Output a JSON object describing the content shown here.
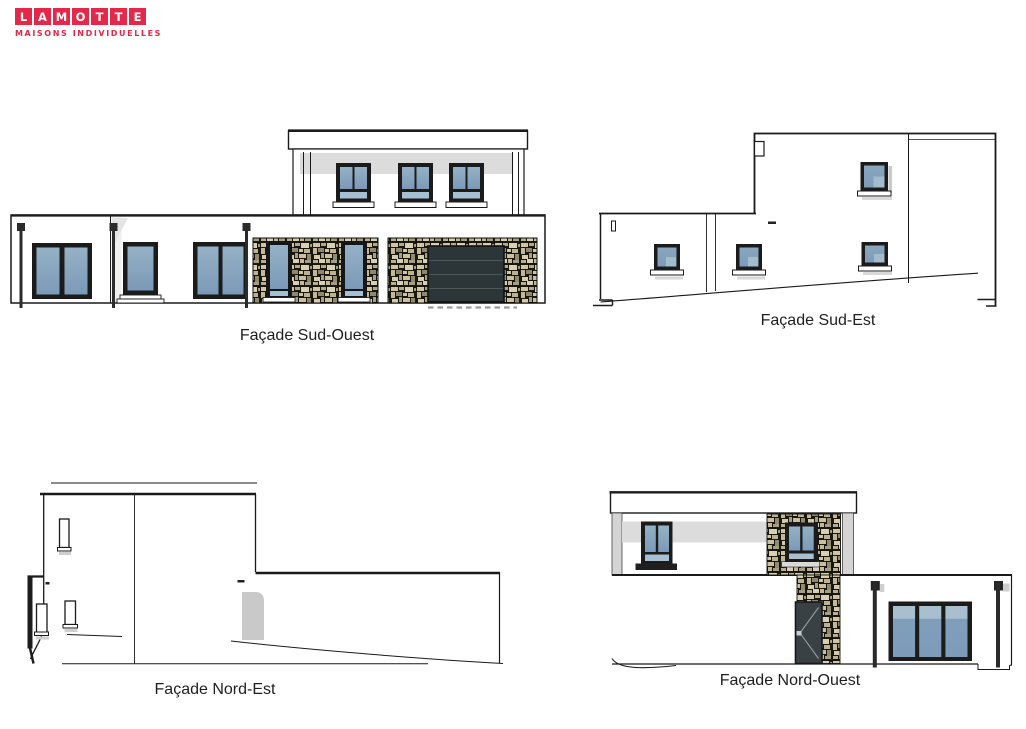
{
  "logo": {
    "letters": [
      "L",
      "A",
      "M",
      "O",
      "T",
      "T",
      "E"
    ],
    "subtitle": "MAISONS INDIVIDUELLES",
    "brand_color": "#e5274a"
  },
  "facades": {
    "sud_ouest": {
      "label": "Façade Sud-Ouest"
    },
    "sud_est": {
      "label": "Façade Sud-Est"
    },
    "nord_est": {
      "label": "Façade Nord-Est"
    },
    "nord_ouest": {
      "label": "Façade Nord-Ouest"
    }
  },
  "colors": {
    "line": "#1a1a1a",
    "glass_blue": "#7d9cba",
    "glass_light": "#a6bfd2",
    "window_frame": "#1b1b1b",
    "shadow_gray": "#dcdcdc",
    "stone_joint": "#17170f",
    "stone_block": "#cfc4a4",
    "garage_door": "#2c3538",
    "entry_door": "#3a4144",
    "utility_door_gray": "#c9c9c9",
    "brand_red": "#e5274a"
  }
}
